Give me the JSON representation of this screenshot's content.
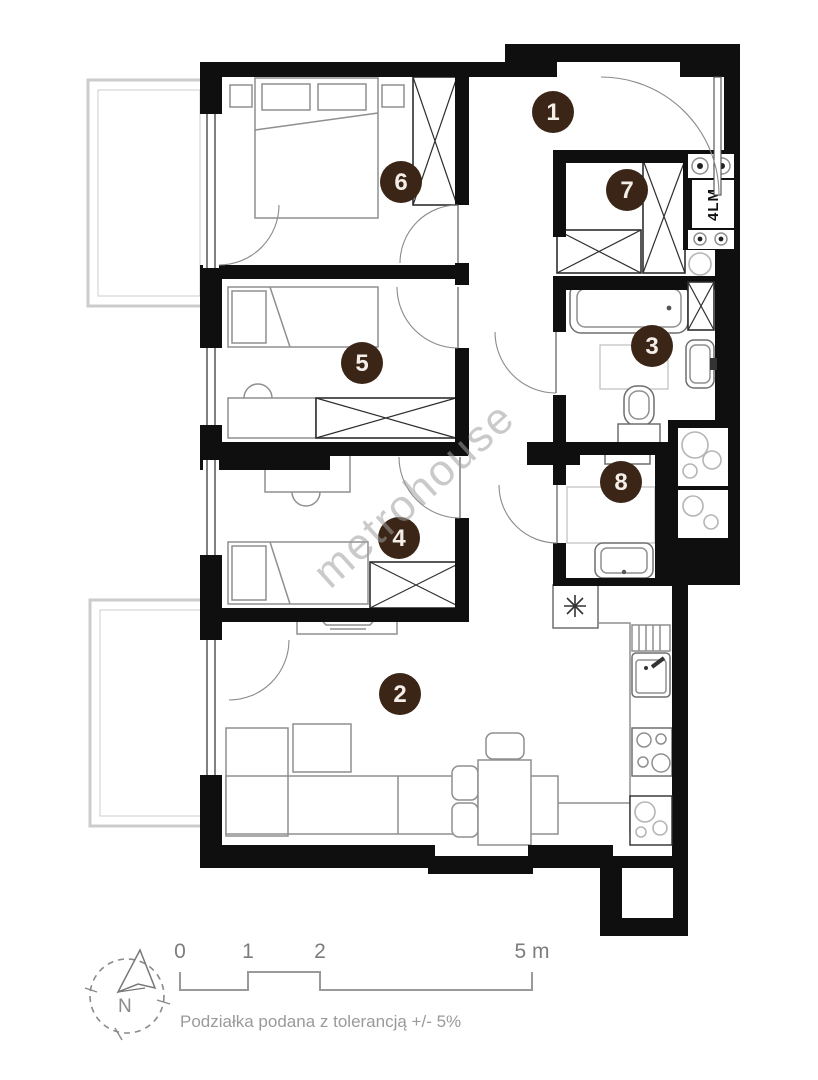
{
  "plan": {
    "watermark": "metrohouse",
    "elevator_label": "4LM",
    "rooms": [
      {
        "number": "1"
      },
      {
        "number": "2"
      },
      {
        "number": "3"
      },
      {
        "number": "4"
      },
      {
        "number": "5"
      },
      {
        "number": "6"
      },
      {
        "number": "7"
      },
      {
        "number": "8"
      }
    ]
  },
  "legend": {
    "north_label": "N",
    "scale_ticks": [
      "0",
      "1",
      "2",
      "5 m"
    ],
    "tolerance_note": "Podziałka podana z tolerancją +/- 5%"
  }
}
